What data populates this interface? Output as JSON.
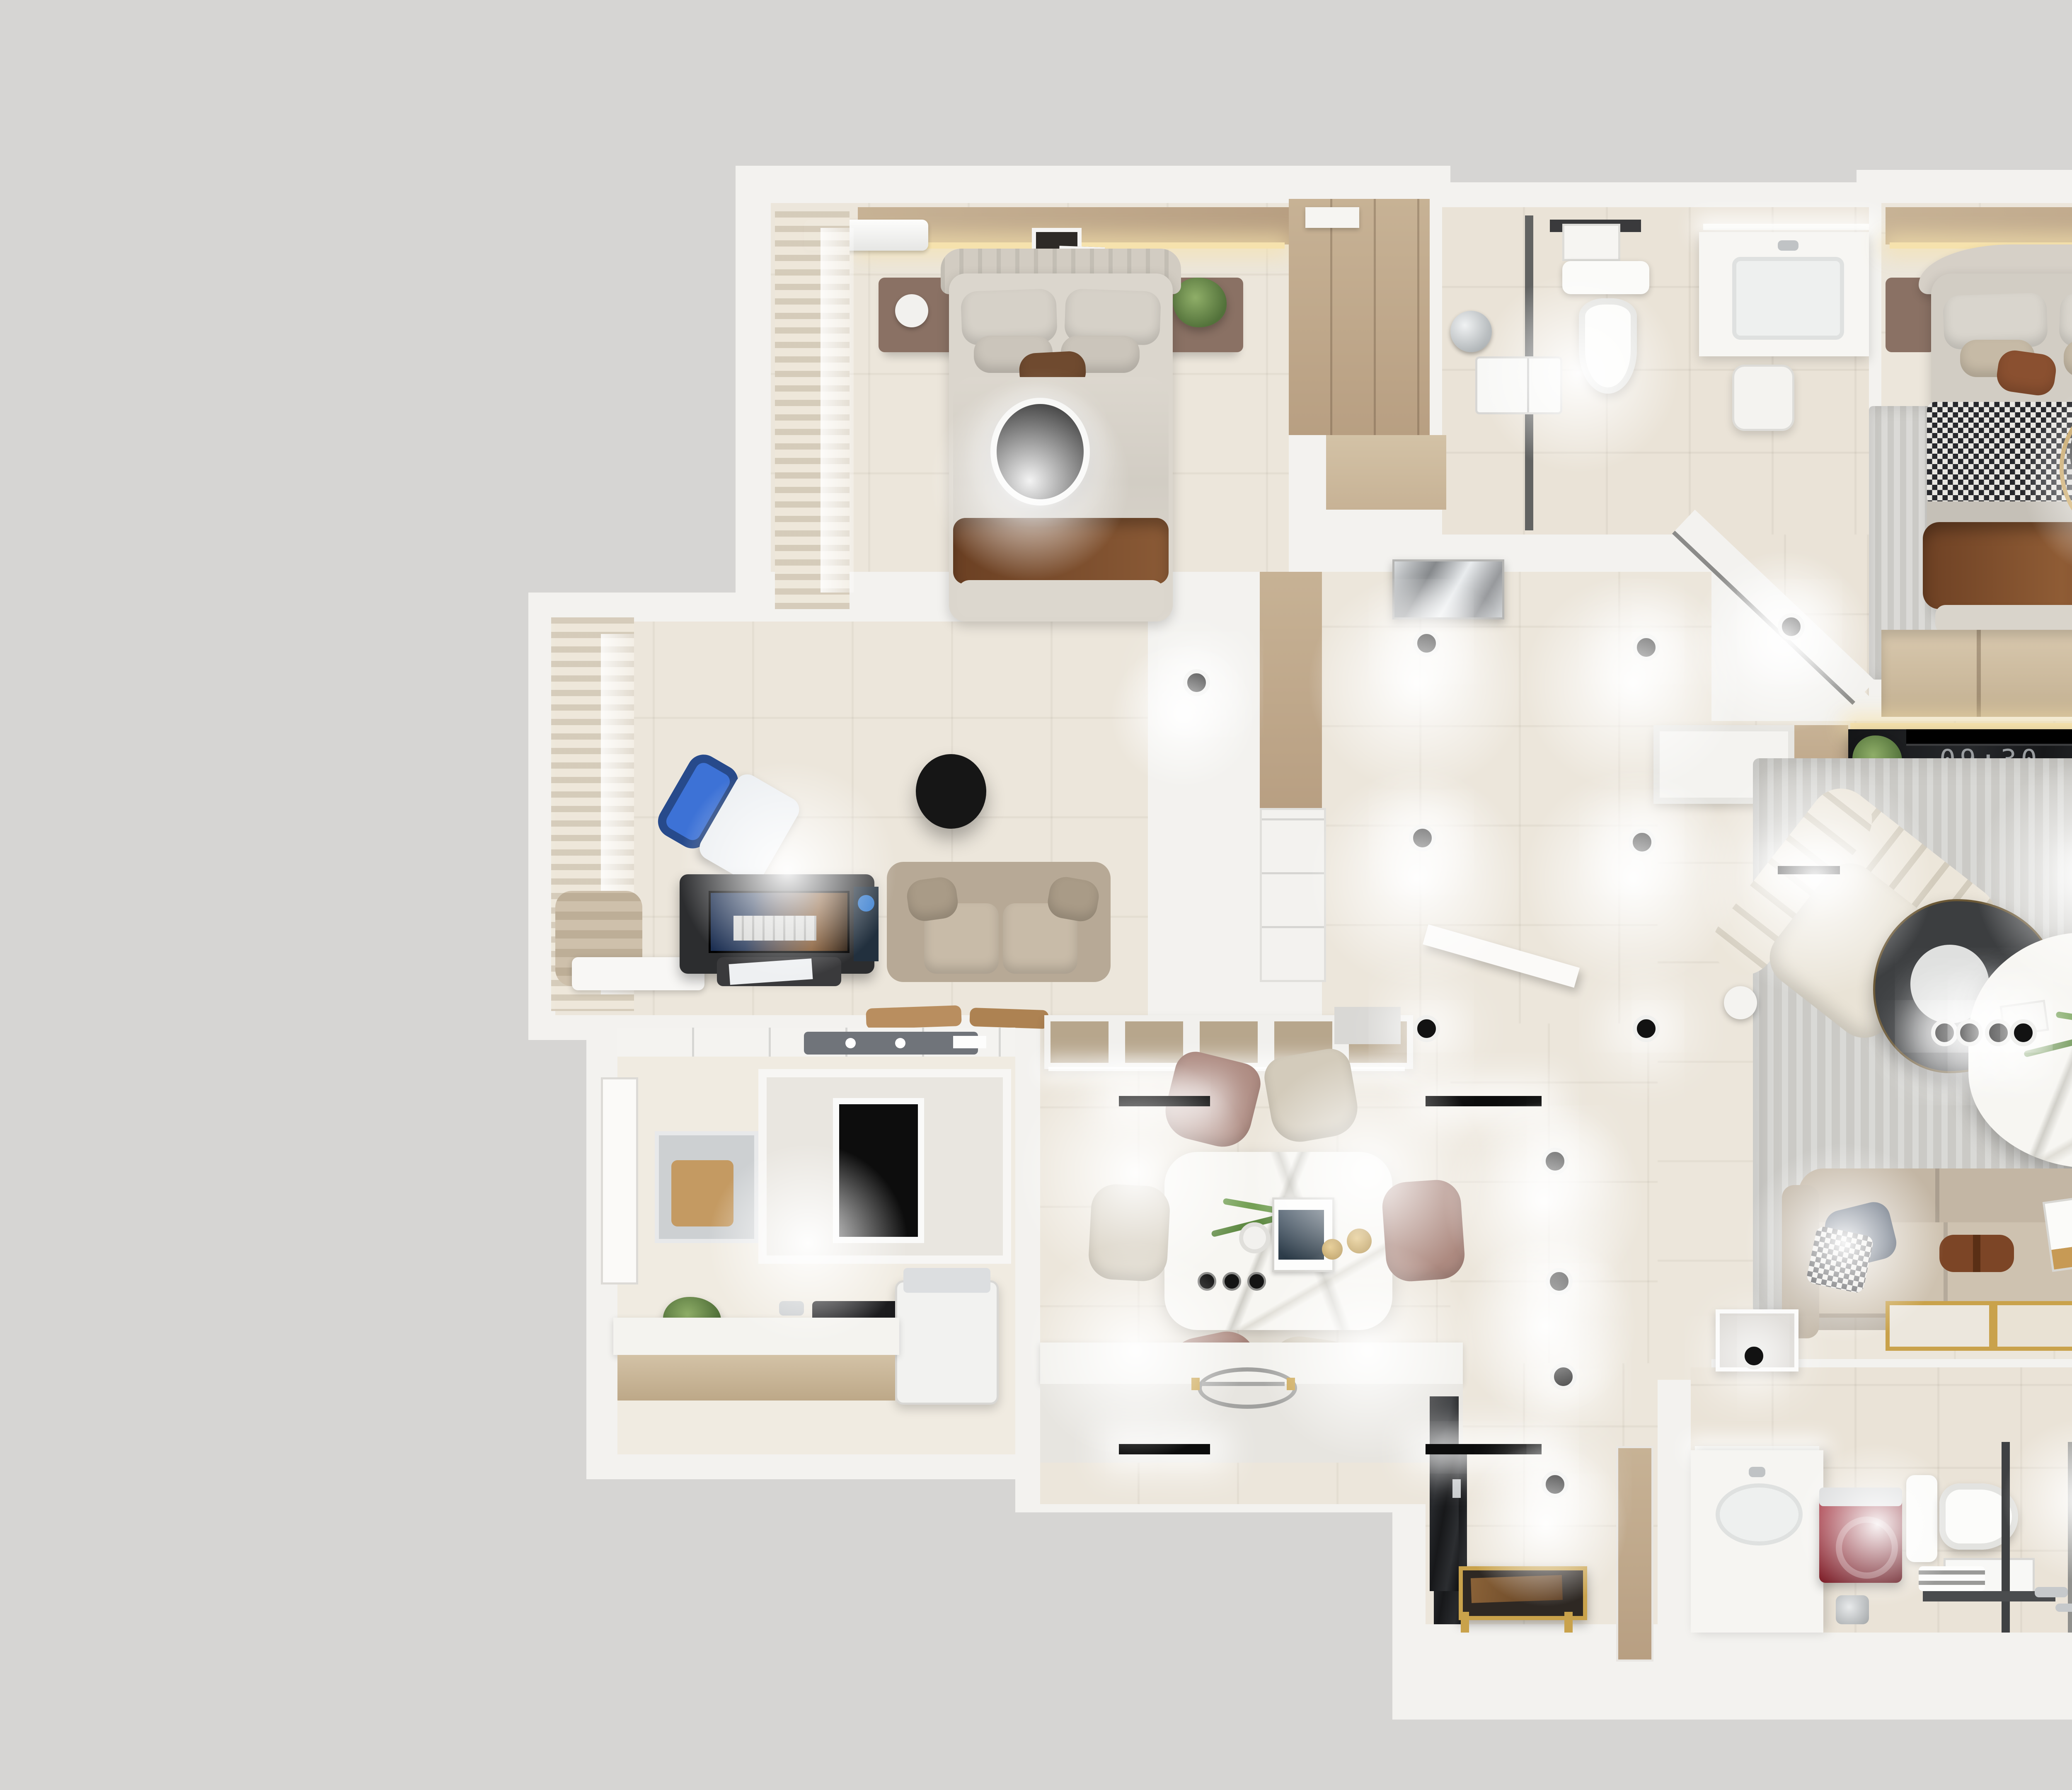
{
  "scene": {
    "type": "3d-floor-plan-render",
    "camera": "top-down",
    "colors": {
      "bg": "#d6d5d3",
      "wall": "#f3f2ef",
      "wallBright": "#fafaf8",
      "floor": "#ece6db",
      "floor2": "#f0ebe1",
      "bath": "#eae3d7",
      "wood1": "#c7b295",
      "wood2": "#b89f82",
      "woodLight": "#d3c2a6",
      "rug": "#cbcac6",
      "sofa": "#c8bba9",
      "sofaDark": "#b7a996",
      "dark": "#17181a",
      "gold": "#c9a24b",
      "green": "#6d8f4e",
      "orange": "#cd862d",
      "brown": "#74432a",
      "mauve": "#ad8a80",
      "cream": "#d3cbbb",
      "blue": "#3d72d6",
      "chrome": "#c9ccce",
      "red": "#9b2330",
      "navy": "#414e61"
    }
  },
  "living_room": {
    "tv_clock": "09:30"
  },
  "rooms": [
    {
      "id": "bedroom-secondary",
      "furniture": [
        "double-bed",
        "nightstand-left",
        "nightstand-right",
        "ceiling-lamp",
        "ac-unit",
        "wall-art",
        "curtains",
        "walk-in-closet"
      ]
    },
    {
      "id": "bathroom-main",
      "furniture": [
        "shower",
        "toilet",
        "vanity-sink",
        "towel-rack",
        "heater-unit",
        "stool"
      ]
    },
    {
      "id": "bedroom-master",
      "furniture": [
        "double-bed",
        "houndstooth-blanket",
        "rug",
        "nightstand-left",
        "nightstand-right",
        "gold-ring-lamp",
        "ac-unit",
        "wall-art",
        "wardrobe",
        "curtains"
      ]
    },
    {
      "id": "study",
      "furniture": [
        "gaming-chair",
        "gaming-desk",
        "monitor",
        "loveseat-sofa",
        "ceiling-lamp",
        "curtains",
        "bench"
      ]
    },
    {
      "id": "laundry",
      "furniture": [
        "counter",
        "washing-machine",
        "wall-cabinet",
        "drying-rack",
        "niche-panel",
        "plant",
        "door"
      ]
    },
    {
      "id": "dining-kitchen",
      "furniture": [
        "marble-dining-table",
        "chairs-x6",
        "sideboard-cabinets",
        "island-counter",
        "wire-tray",
        "track-lights"
      ]
    },
    {
      "id": "hallway",
      "furniture": [
        "storage-column",
        "metal-wall-art",
        "diagonal-wall",
        "pivot-door",
        "downlights"
      ]
    },
    {
      "id": "living-room",
      "furniture": [
        "sectional-sofa",
        "chaise",
        "velvet-throw",
        "lounge-chair",
        "coffee-table-dark",
        "coffee-table-marble",
        "tv-console",
        "tv",
        "chrome-cabinet",
        "rug",
        "gold-framed-art",
        "half-wall"
      ]
    },
    {
      "id": "tea-balcony",
      "furniture": [
        "tea-desk",
        "tea-set",
        "accent-chair",
        "gold-kettle",
        "plant",
        "venetian-blinds",
        "bay-window"
      ]
    },
    {
      "id": "entry",
      "furniture": [
        "shoe-cabinet",
        "gold-leg-bench",
        "wood-door"
      ]
    },
    {
      "id": "bathroom-ensuite",
      "furniture": [
        "vanity-sink",
        "washing-machine-red",
        "toilet",
        "shower-glass",
        "heater-unit",
        "round-mirror",
        "bath-mat"
      ]
    }
  ]
}
